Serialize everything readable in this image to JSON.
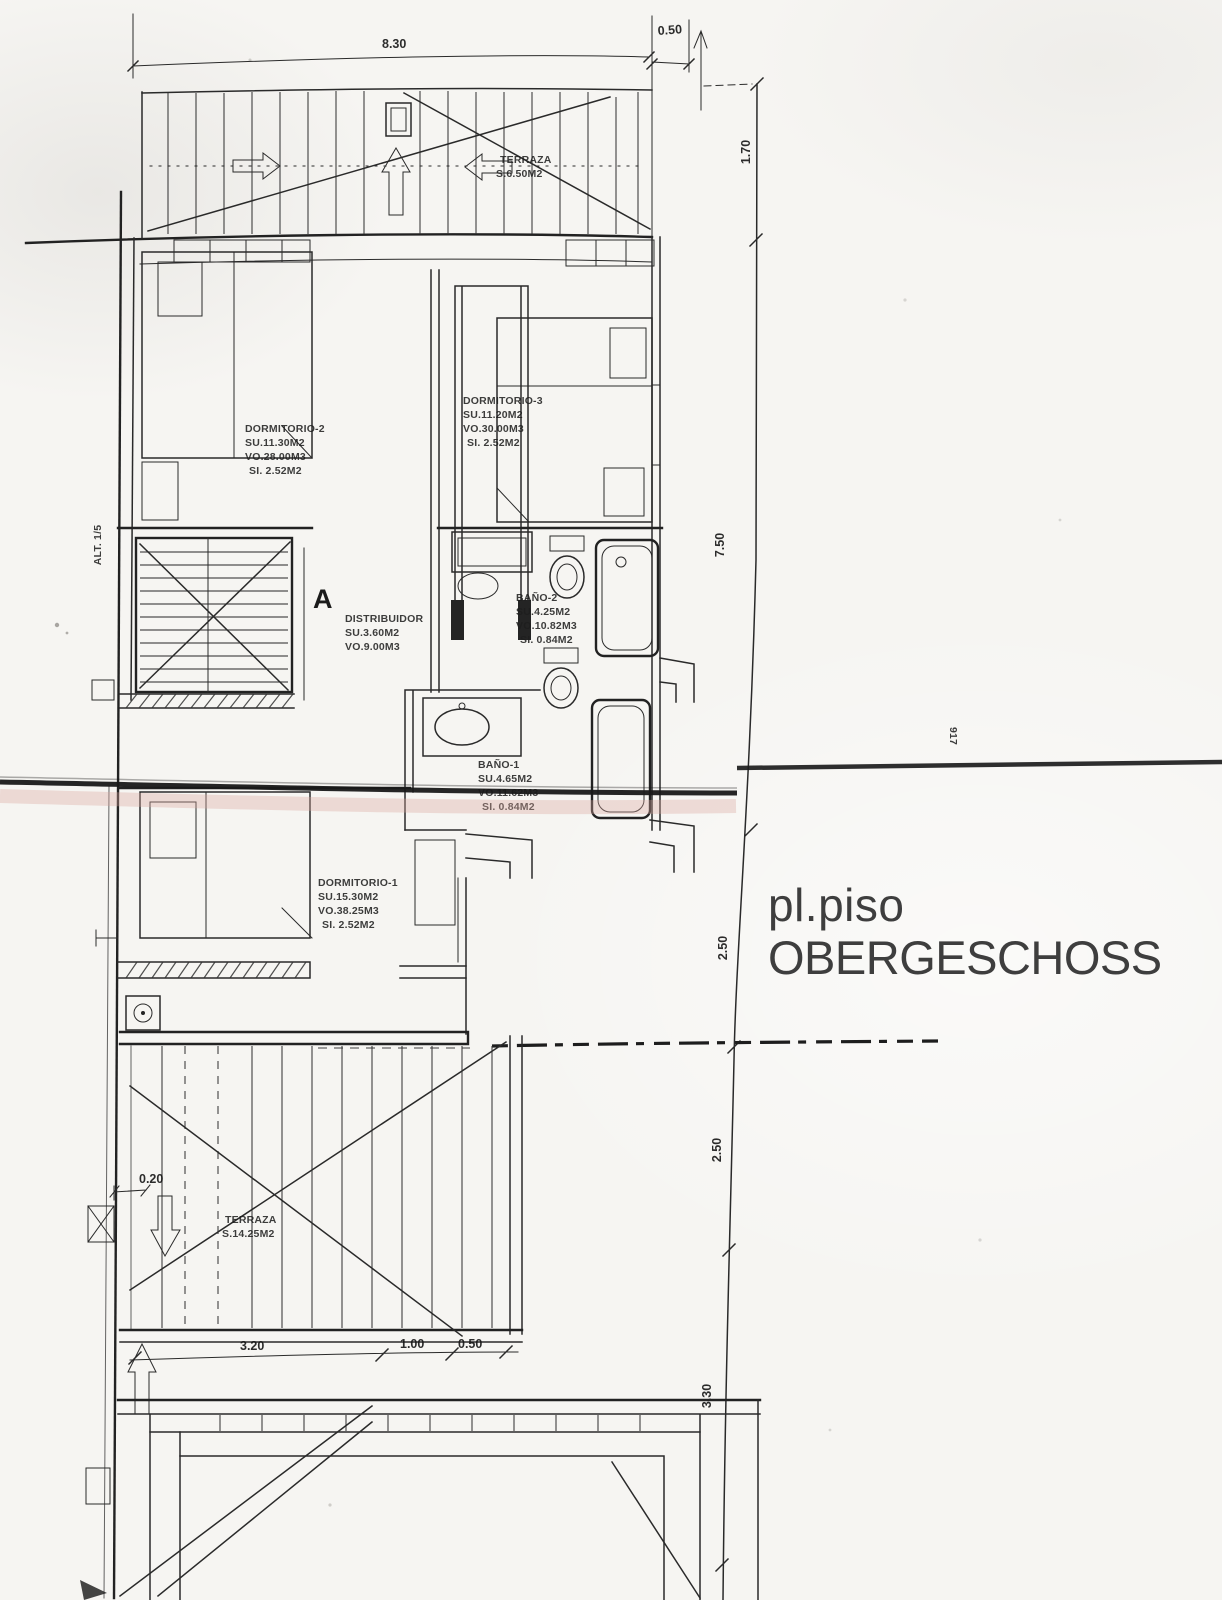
{
  "title": {
    "line1": "pl.piso",
    "line2": "OBERGESCHOSS"
  },
  "rooms": {
    "terraza_top": {
      "name": "TERRAZA",
      "area": "S.6.50M2"
    },
    "dormitorio_2": {
      "name": "DORMITORIO-2",
      "su": "SU.11.30M2",
      "vo": "VO.28.00M3",
      "si": "SI. 2.52M2"
    },
    "dormitorio_3": {
      "name": "DORMITORIO-3",
      "su": "SU.11.20M2",
      "vo": "VO.30.00M3",
      "si": "SI. 2.52M2"
    },
    "distribuidor": {
      "name": "DISTRIBUIDOR",
      "su": "SU.3.60M2",
      "vo": "VO.9.00M3"
    },
    "bano_2": {
      "name": "BAÑO-2",
      "su": "SU.4.25M2",
      "vo": "VO.10.82M3",
      "si": "SI. 0.84M2"
    },
    "bano_1": {
      "name": "BAÑO-1",
      "su": "SU.4.65M2",
      "vo": "VO.11.62M3",
      "si": "SI. 0.84M2"
    },
    "dormitorio_1": {
      "name": "DORMITORIO-1",
      "su": "SU.15.30M2",
      "vo": "VO.38.25M3",
      "si": "SI. 2.52M2"
    },
    "terraza_bottom": {
      "name": "TERRAZA",
      "area": "S.14.25M2"
    }
  },
  "dimensions": {
    "top_width": "8.30",
    "top_offset": "0.50",
    "right_top": "1.70",
    "right_upper": "7.50",
    "right_mid1": "2.50",
    "right_mid2": "2.50",
    "right_lower": "3.30",
    "left_offset": "0.20",
    "bottom_1": "3.20",
    "bottom_2": "1.00",
    "bottom_3": "0.50"
  },
  "annotations": {
    "section_mark": "A",
    "stair_note": "ALT. 1/5",
    "side_note": "917"
  },
  "colors": {
    "ink": "#2a2a2a",
    "paper": "#f6f5f2",
    "fold_line": "#191919",
    "fold_tint": "#dba79e",
    "title_text": "#3e3e3e"
  }
}
